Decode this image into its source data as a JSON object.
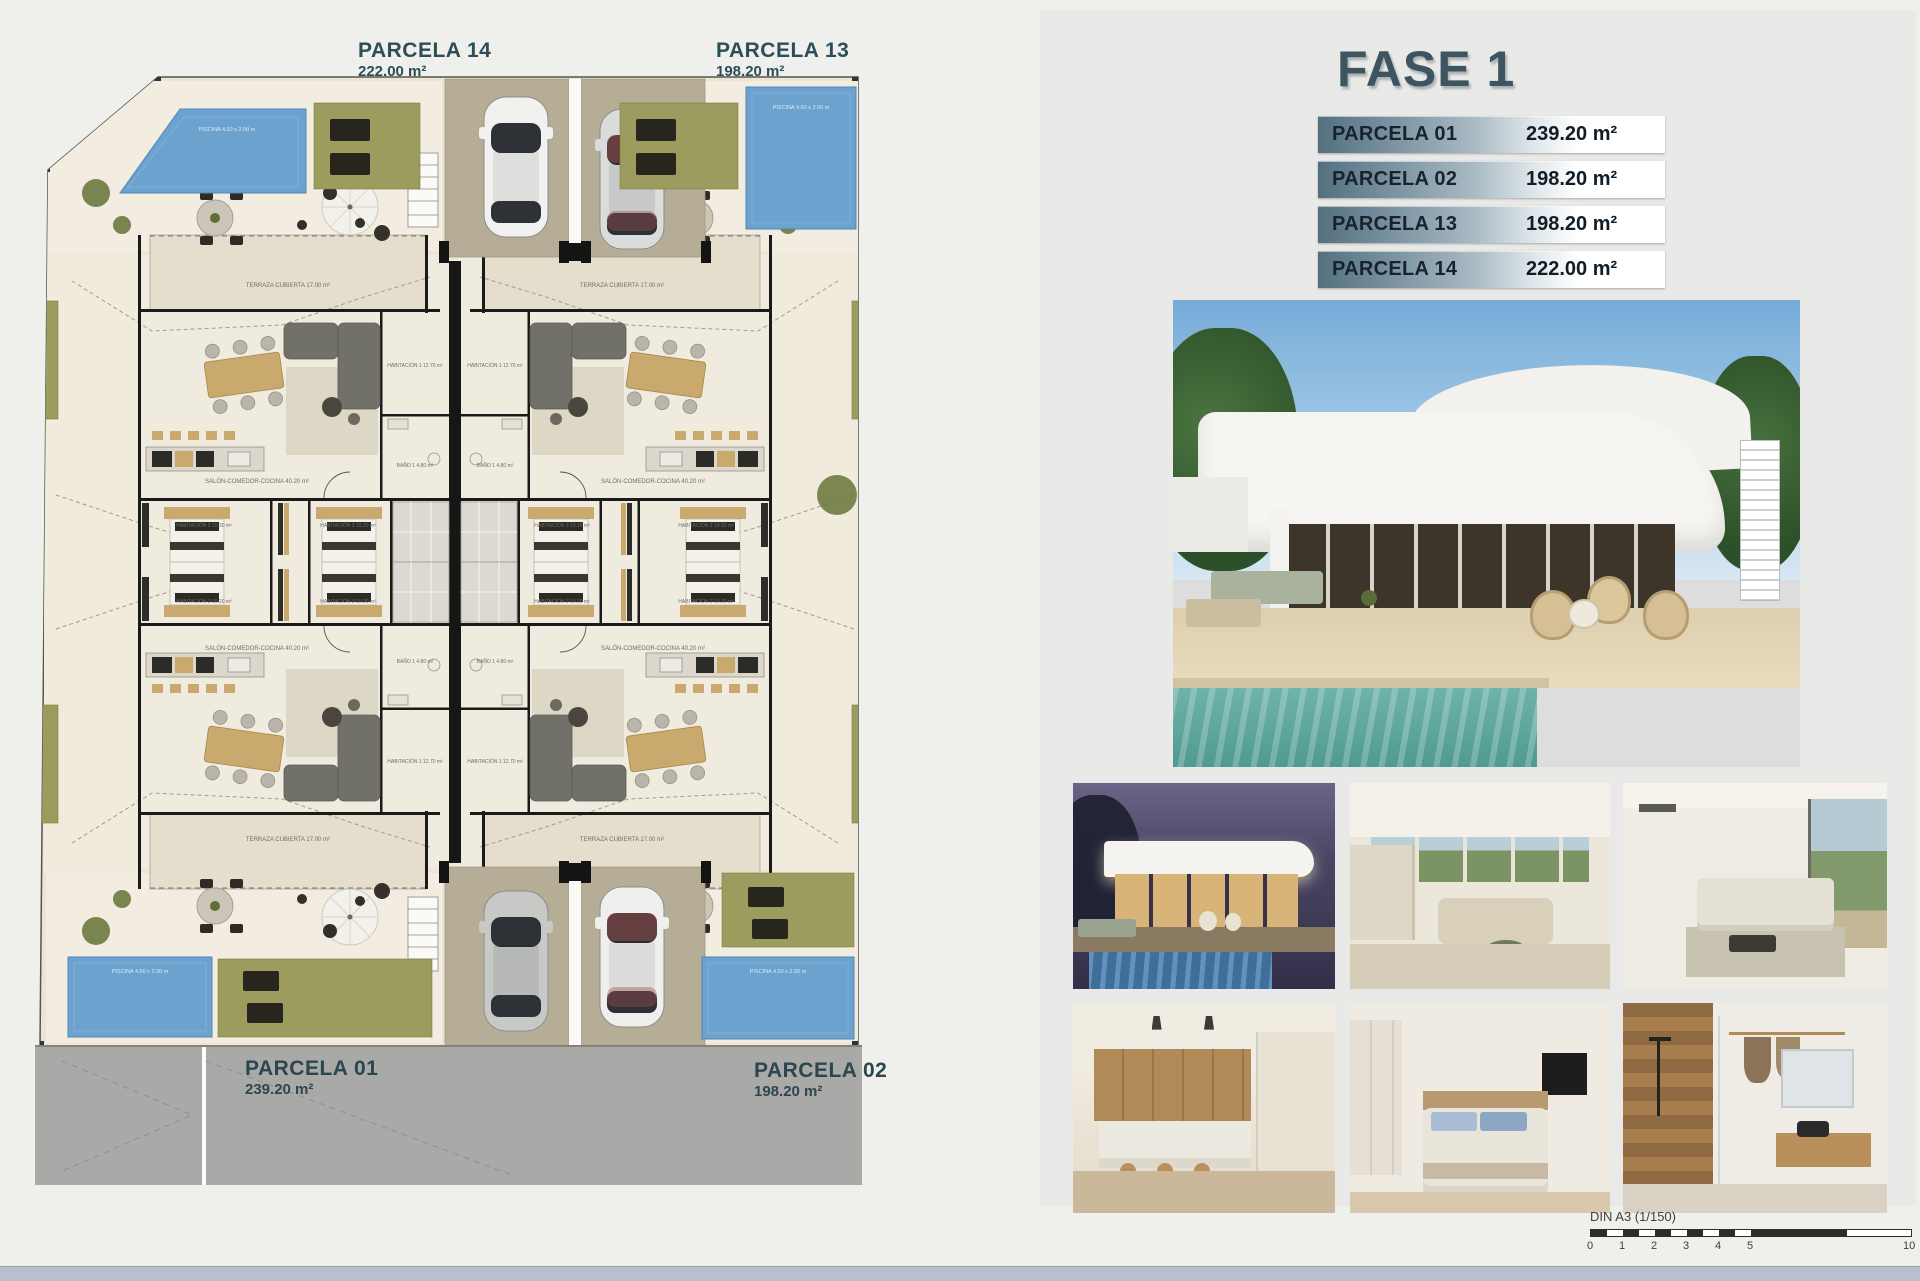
{
  "plan": {
    "labels": {
      "p14": {
        "name": "PARCELA 14",
        "area": "222.00 m²"
      },
      "p13": {
        "name": "PARCELA 13",
        "area": "198.20 m²"
      },
      "p01": {
        "name": "PARCELA 01",
        "area": "239.20 m²"
      },
      "p02": {
        "name": "PARCELA 02",
        "area": "198.20 m²"
      }
    },
    "rooms": {
      "terraza": "TERRAZA CUBIERTA 17.00 m²",
      "salon": "SALÓN-COMEDOR-COCINA 40.20 m²",
      "hab1": "HABITACIÓN 1 12.70 m²",
      "hab2": "HABITACIÓN 2 10.20 m²",
      "hab3": "HABITACIÓN 3 10.20 m²",
      "bano1": "BAÑO 1 4.80 m²"
    },
    "pool_label": "PISCINA 4.50 x 2.00 m"
  },
  "fase": {
    "title": "FASE 1",
    "rows": [
      {
        "label": "PARCELA 01",
        "area": "239.20 m²"
      },
      {
        "label": "PARCELA 02",
        "area": "198.20 m²"
      },
      {
        "label": "PARCELA 13",
        "area": "198.20 m²"
      },
      {
        "label": "PARCELA 14",
        "area": "222.00 m²"
      }
    ]
  },
  "photos": {
    "main": "villa-exterior-render",
    "grid": [
      "night-exterior-pool",
      "open-plan-living-kitchen",
      "living-room-sofa",
      "kitchen-dining-island",
      "bedroom-tv",
      "bathroom-shower"
    ]
  },
  "scalebar": {
    "label": "DIN A3 (1/150)",
    "ticks": [
      "0",
      "1",
      "2",
      "3",
      "4",
      "5",
      "10"
    ]
  },
  "colors": {
    "teal_label": "#2d4d58",
    "fase_title": "#3c5560",
    "pool_blue": "#6ba2ce",
    "grass_green": "#9c9c5e",
    "driveway_tan": "#b6ad97",
    "street_gray": "#a9a9a7",
    "footer_strip": "#b6c1cd",
    "table_row_dark": "#54707f"
  }
}
